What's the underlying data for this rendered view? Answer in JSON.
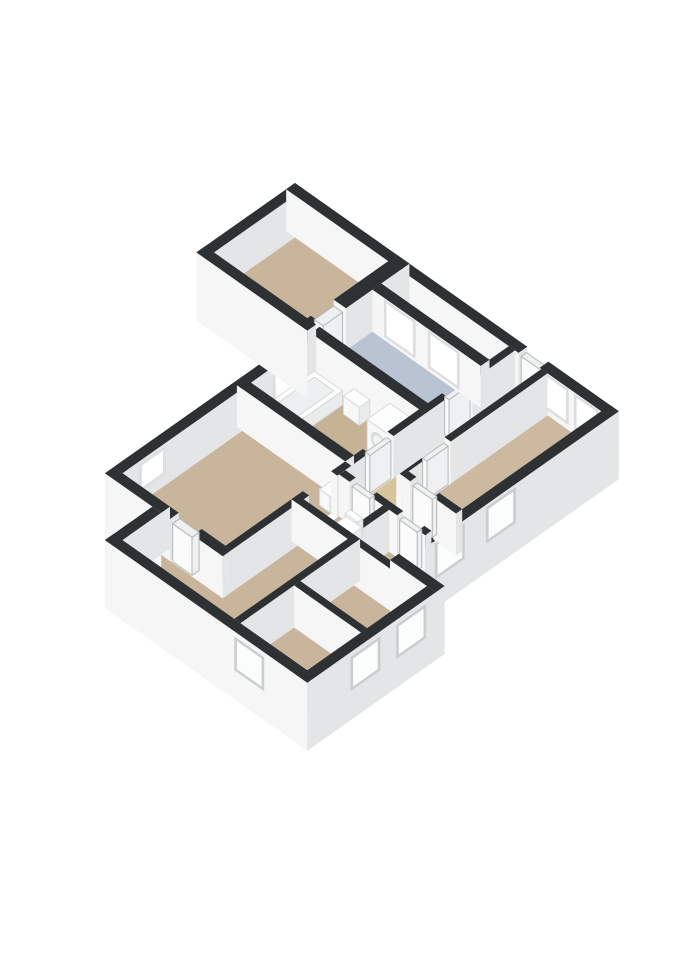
{
  "meta": {
    "view_label": "3d-floor-plan-isometric"
  },
  "projection": {
    "ox": 295,
    "oy": 225,
    "kx": 0.88,
    "ky": 0.62,
    "wall_height": 42,
    "door_height": 38
  },
  "palette": {
    "background": "#ffffff",
    "wall_top": "#2e3133",
    "face_v": "#f6f6f7",
    "face_u": "#e3e5e6",
    "floor_tan": "#c9b59b",
    "floor_tan_light": "#cdb99f",
    "floor_tan_bath": "#c6b295",
    "floor_hall": "#d8c49c",
    "floor_blue": "#b9c3d1",
    "floor_void": "#3c3f41",
    "win_frame_in": "#dcdedf",
    "win_glass_in": "#ffffff",
    "win_frame_ext": "#cbced0",
    "win_glass_ext": "#fbfcfc",
    "door_face": "#fbfbfc",
    "door_side": "#eef0f1",
    "door_top": "#eff0f1",
    "door_stroke": "#b5b8b9",
    "fix_top": "#fdfdfd",
    "fix_v": "#f7f8f8",
    "fix_u": "#e9ebec",
    "fix_stroke": "#d8dadb",
    "tub_inset": "#edeff0",
    "tub_inset_stroke": "#d3d6d7",
    "drum_ring": "#d8dadb",
    "drum_center": "#f3f4f5"
  },
  "floors": [
    {
      "name": "floor-bedroom-1",
      "color_key": "floor_tan",
      "rect": [
        10,
        10,
        116,
        102
      ]
    },
    {
      "name": "floor-void-strip",
      "color_key": "floor_void",
      "rect": [
        130,
        10,
        253,
        32
      ]
    },
    {
      "name": "floor-bathroom-blue",
      "color_key": "floor_blue",
      "rect": [
        130,
        42,
        253,
        102
      ]
    },
    {
      "name": "floor-hallway",
      "color_key": "floor_hall",
      "poly": [
        [
          260,
          10
        ],
        [
          290,
          10
        ],
        [
          290,
          175
        ],
        [
          358,
          175
        ],
        [
          358,
          203
        ],
        [
          260,
          203
        ]
      ]
    },
    {
      "name": "floor-bedroom-2",
      "color_key": "floor_tan_light",
      "rect": [
        297,
        10,
        358,
        168
      ]
    },
    {
      "name": "floor-bathroom",
      "color_key": "floor_tan_bath",
      "rect": [
        136,
        112,
        253,
        186
      ]
    },
    {
      "name": "floor-living-room",
      "color_key": "floor_tan",
      "rect": [
        136,
        196,
        253,
        332
      ]
    },
    {
      "name": "floor-toilet",
      "color_key": "floor_tan",
      "rect": [
        260,
        210,
        310,
        250
      ]
    },
    {
      "name": "floor-storage-1",
      "color_key": "floor_tan",
      "rect": [
        317,
        210,
        358,
        240
      ]
    },
    {
      "name": "floor-study",
      "color_key": "floor_tan",
      "rect": [
        324,
        257,
        400,
        318
      ]
    },
    {
      "name": "floor-storage-2",
      "color_key": "floor_tan",
      "rect": [
        324,
        325,
        400,
        386
      ]
    },
    {
      "name": "floor-bedroom-3",
      "color_key": "floor_tan",
      "poly": [
        [
          260,
          257
        ],
        [
          317,
          257
        ],
        [
          317,
          386
        ],
        [
          190,
          386
        ],
        [
          190,
          342
        ],
        [
          260,
          342
        ]
      ]
    }
  ],
  "prisms": [
    {
      "name": "ext-wall-west-bed1",
      "kind": "wall",
      "r": [
        0,
        0,
        10,
        112
      ]
    },
    {
      "name": "ext-wall-north-a",
      "kind": "wall",
      "r": [
        0,
        0,
        264,
        10
      ]
    },
    {
      "name": "entry-door",
      "kind": "door",
      "r": [
        265,
        2,
        287,
        8
      ]
    },
    {
      "name": "ext-wall-north-b",
      "kind": "wall",
      "r": [
        288,
        0,
        368,
        10
      ],
      "decals": [
        {
          "t": "win",
          "f": "v",
          "a1": 296,
          "a2": 318,
          "z1": 8,
          "z2": 38,
          "s": "in"
        },
        {
          "t": "win",
          "f": "v",
          "a1": 330,
          "a2": 352,
          "z1": 8,
          "z2": 38,
          "s": "in"
        }
      ]
    },
    {
      "name": "wall-bed1-east-a",
      "kind": "wall",
      "r": [
        116,
        0,
        130,
        72
      ]
    },
    {
      "name": "wall-bed1-east-b",
      "kind": "wall",
      "r": [
        116,
        98,
        130,
        112
      ]
    },
    {
      "name": "door-bedroom-1",
      "kind": "door",
      "r": [
        118,
        74,
        128,
        96
      ]
    },
    {
      "name": "wall-blue-east-a",
      "kind": "wall",
      "r": [
        253,
        10,
        260,
        58
      ]
    },
    {
      "name": "wall-blue-east-b",
      "kind": "wall",
      "r": [
        253,
        86,
        260,
        112
      ]
    },
    {
      "name": "door-blue-room",
      "kind": "door",
      "r": [
        254,
        60,
        259,
        84
      ]
    },
    {
      "name": "wall-hall-east-a",
      "kind": "wall",
      "r": [
        290,
        10,
        297,
        120
      ]
    },
    {
      "name": "wall-hall-east-b",
      "kind": "wall",
      "r": [
        290,
        148,
        297,
        175
      ]
    },
    {
      "name": "door-bedroom-2-north",
      "kind": "door",
      "r": [
        291,
        122,
        296,
        146
      ]
    },
    {
      "name": "ext-wall-east-upper",
      "kind": "wall",
      "r": [
        358,
        0,
        368,
        240
      ],
      "du": -26,
      "dv": -26,
      "decals": [
        {
          "t": "win",
          "f": "u",
          "a1": 120,
          "a2": 148,
          "z1": 6,
          "z2": 36,
          "s": "ext"
        },
        {
          "t": "win",
          "f": "u",
          "a1": 178,
          "a2": 206,
          "z1": 6,
          "z2": 36,
          "s": "ext"
        }
      ]
    },
    {
      "name": "wall-blue-window",
      "kind": "wall",
      "r": [
        130,
        32,
        253,
        42
      ],
      "decals": [
        {
          "t": "win",
          "f": "v",
          "a1": 146,
          "a2": 176,
          "z1": 6,
          "z2": 38,
          "s": "in"
        },
        {
          "t": "win",
          "f": "v",
          "a1": 196,
          "a2": 226,
          "z1": 6,
          "z2": 38,
          "s": "in"
        }
      ]
    },
    {
      "name": "wall-blue-south",
      "kind": "wall",
      "r": [
        130,
        102,
        260,
        112
      ]
    },
    {
      "name": "sink-bathroom",
      "kind": "fixture",
      "r": [
        180,
        113,
        198,
        125
      ],
      "h": 18
    },
    {
      "name": "washing-machine",
      "kind": "fixture",
      "r": [
        222,
        114,
        248,
        140
      ],
      "h": 30,
      "decals": [
        {
          "t": "circle",
          "f": "v"
        }
      ]
    },
    {
      "name": "ext-wall-west-main",
      "kind": "wall",
      "r": [
        126,
        112,
        136,
        332
      ],
      "decals": [
        {
          "t": "win",
          "f": "u",
          "a1": 128,
          "a2": 158,
          "z1": 8,
          "z2": 38,
          "s": "in"
        },
        {
          "t": "win",
          "f": "u",
          "a1": 286,
          "a2": 310,
          "z1": 14,
          "z2": 36,
          "s": "in"
        }
      ]
    },
    {
      "name": "bathtub",
      "kind": "fixture",
      "r": [
        140,
        118,
        172,
        184
      ],
      "h": 14,
      "decals": [
        {
          "t": "inset"
        }
      ]
    },
    {
      "name": "ext-wall-south-bed1",
      "kind": "wall",
      "r": [
        0,
        102,
        126,
        112
      ],
      "dv": -26
    },
    {
      "name": "wall-bath-east-a",
      "kind": "wall",
      "r": [
        253,
        112,
        260,
        148
      ]
    },
    {
      "name": "wall-bath-east-b",
      "kind": "wall",
      "r": [
        253,
        176,
        260,
        196
      ]
    },
    {
      "name": "door-bathroom",
      "kind": "door",
      "r": [
        254,
        150,
        259,
        174
      ]
    },
    {
      "name": "wall-bed2-south-a",
      "kind": "wall",
      "r": [
        297,
        168,
        306,
        175
      ]
    },
    {
      "name": "wall-bed2-south-b",
      "kind": "wall",
      "r": [
        332,
        168,
        358,
        175
      ]
    },
    {
      "name": "door-bedroom-2-south",
      "kind": "door",
      "r": [
        308,
        169,
        330,
        174
      ]
    },
    {
      "name": "wall-bath-south",
      "kind": "wall",
      "r": [
        130,
        186,
        253,
        196
      ]
    },
    {
      "name": "cabinet-living",
      "kind": "fixture",
      "r": [
        240,
        198,
        252,
        212
      ],
      "h": 16
    },
    {
      "name": "wall-living-east-a",
      "kind": "wall",
      "r": [
        253,
        196,
        260,
        212
      ]
    },
    {
      "name": "wall-living-east-b",
      "kind": "wall",
      "r": [
        253,
        244,
        260,
        332
      ]
    },
    {
      "name": "wall-corridor-south-a",
      "kind": "wall",
      "r": [
        260,
        203,
        272,
        210
      ]
    },
    {
      "name": "wall-corridor-south-b",
      "kind": "wall",
      "r": [
        296,
        203,
        326,
        210
      ]
    },
    {
      "name": "wall-corridor-south-c",
      "kind": "wall",
      "r": [
        350,
        203,
        358,
        210
      ]
    },
    {
      "name": "door-toilet",
      "kind": "door",
      "r": [
        274,
        204,
        294,
        209
      ]
    },
    {
      "name": "door-storage",
      "kind": "door",
      "r": [
        328,
        204,
        348,
        209
      ]
    },
    {
      "name": "wall-toilet-east",
      "kind": "wall",
      "r": [
        310,
        210,
        317,
        257
      ]
    },
    {
      "name": "toilet-tank",
      "kind": "fixture",
      "r": [
        274,
        211,
        288,
        217
      ],
      "h": 16
    },
    {
      "name": "toilet",
      "kind": "fixture",
      "r": [
        272,
        214,
        290,
        228
      ],
      "h": 10
    },
    {
      "name": "wall-mid-south",
      "kind": "wall",
      "r": [
        253,
        250,
        400,
        257
      ]
    },
    {
      "name": "ext-wall-step",
      "kind": "wall",
      "r": [
        358,
        240,
        410,
        250
      ],
      "du": -26,
      "dv": -26
    },
    {
      "name": "wall-divider-east",
      "kind": "wall",
      "r": [
        317,
        250,
        324,
        386
      ]
    },
    {
      "name": "wall-study-storage",
      "kind": "wall",
      "r": [
        324,
        318,
        400,
        325
      ]
    },
    {
      "name": "wall-bed3-north-a",
      "kind": "wall",
      "r": [
        190,
        332,
        200,
        342
      ]
    },
    {
      "name": "wall-bed3-north-b",
      "kind": "wall",
      "r": [
        226,
        332,
        260,
        342
      ]
    },
    {
      "name": "door-bedroom-3",
      "kind": "door",
      "r": [
        202,
        333,
        224,
        341
      ]
    },
    {
      "name": "ext-wall-south-living",
      "kind": "wall",
      "r": [
        126,
        332,
        190,
        342
      ],
      "dv": -26
    },
    {
      "name": "ext-wall-west-bottom",
      "kind": "wall",
      "r": [
        180,
        342,
        190,
        396
      ],
      "dv": -26
    },
    {
      "name": "ext-wall-east-lower",
      "kind": "wall",
      "r": [
        400,
        250,
        410,
        396
      ],
      "du": -26,
      "dv": -26,
      "decals": [
        {
          "t": "win",
          "f": "u",
          "a1": 264,
          "a2": 292,
          "z1": 6,
          "z2": 34,
          "s": "ext"
        },
        {
          "t": "win",
          "f": "u",
          "a1": 316,
          "a2": 344,
          "z1": 6,
          "z2": 34,
          "s": "ext"
        }
      ]
    },
    {
      "name": "ext-wall-south",
      "kind": "wall",
      "r": [
        180,
        386,
        410,
        396
      ],
      "du": -26,
      "dv": -26,
      "decals": [
        {
          "t": "win",
          "f": "v",
          "a1": 330,
          "a2": 358,
          "z1": 6,
          "z2": 34,
          "s": "ext"
        }
      ]
    }
  ]
}
